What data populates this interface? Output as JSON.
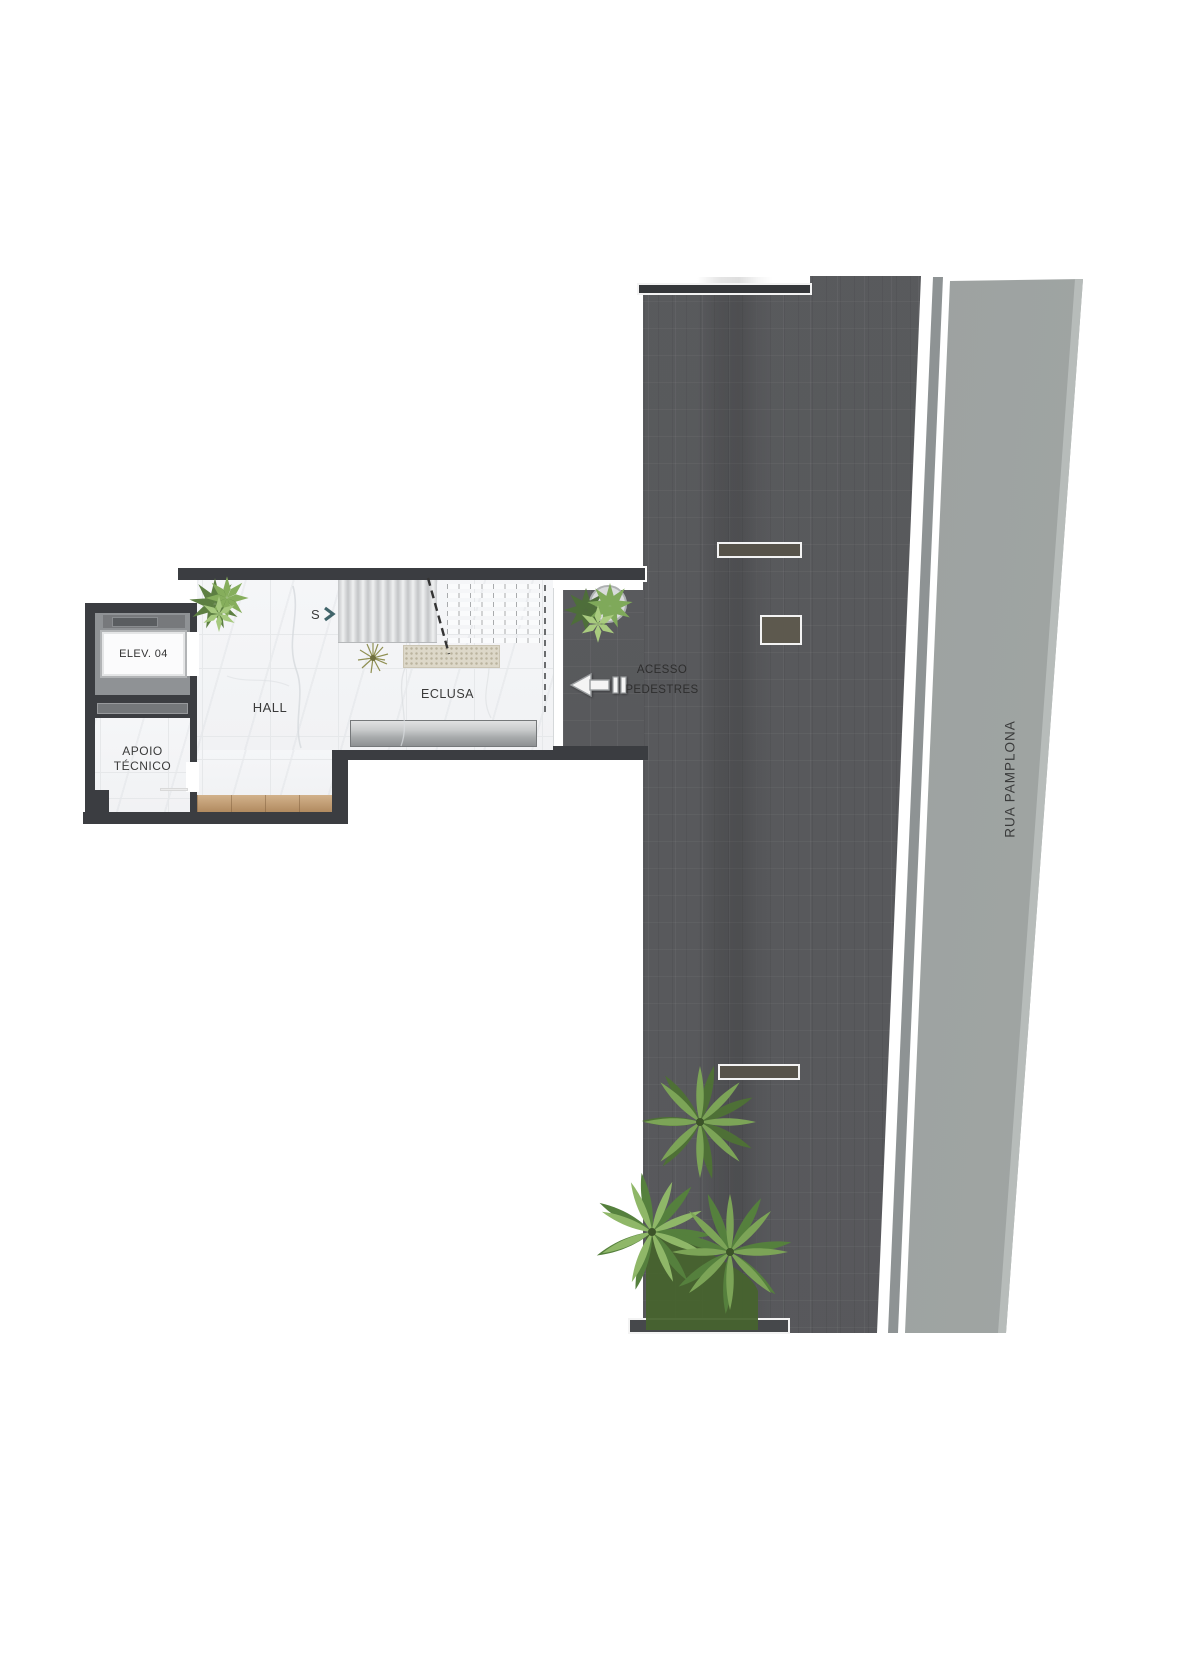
{
  "plan": {
    "type": "architectural-floor-plan",
    "labels": {
      "elevator": "ELEV. 04",
      "apoio_line1": "APOIO",
      "apoio_line2": "TÉCNICO",
      "hall": "HALL",
      "eclusa": "ECLUSA",
      "stair_direction": "S",
      "access_line1": "ACESSO",
      "access_line2": "PEDESTRES",
      "street_name": "RUA PAMPLONA"
    },
    "icons": {
      "stair_direction": "chevron-right-icon",
      "pedestrian_access": "arrow-left-icon",
      "plants": [
        "shrub",
        "shrub-cluster",
        "palm",
        "palm",
        "palm",
        "olive-tuft"
      ]
    },
    "colors": {
      "pavement": "#595a5d",
      "street": "#9ba09f",
      "gutter": "#8e9394",
      "wall": "#3b3d41",
      "marble_floor": "#f4f5f7",
      "wood_floor": "#c8a172",
      "landing": "#ddd8c9",
      "mat_gradient_top": "#e0e1e2",
      "mat_gradient_bottom": "#8d9092",
      "plant_green": "#7ca457",
      "chevron_teal": "#41646a"
    }
  }
}
